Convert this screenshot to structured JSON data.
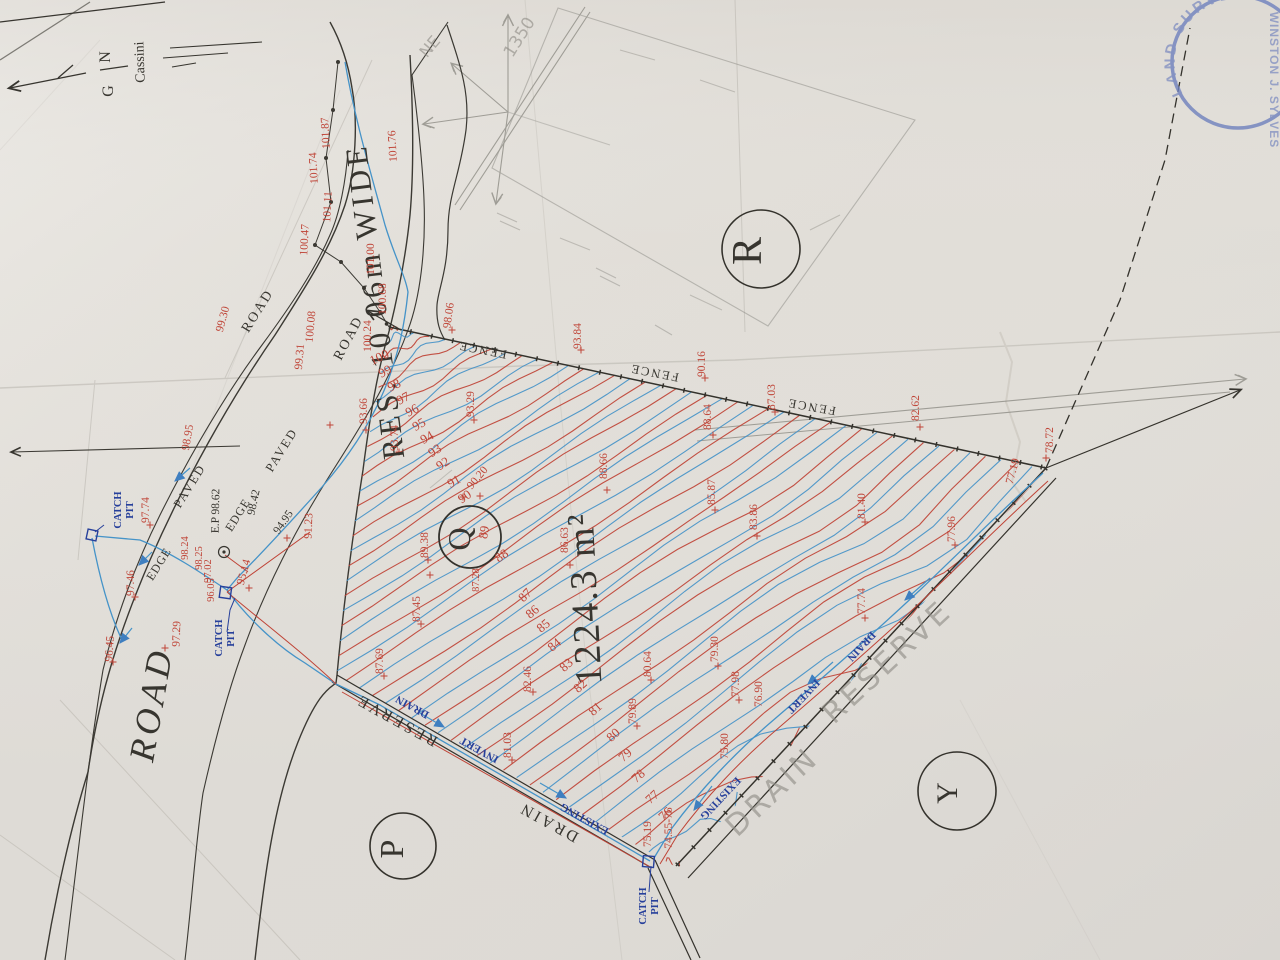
{
  "colors": {
    "paper": "#e1ded8",
    "red": "#bf4336",
    "blue": "#4593c8",
    "navy": "#27409b",
    "ink": "#37352f",
    "pencil": "#8e8c85",
    "stamp": "#6e80bd"
  },
  "parcel": {
    "id": "Q",
    "area": "1224.3 m²",
    "adjacent": [
      "R",
      "P",
      "Y"
    ]
  },
  "north": {
    "letters": "G N",
    "datum": "Cassini"
  },
  "stamp": {
    "arc_text": "LAND SURVEY BO",
    "name_text": "WINSTON J. SYLVES"
  },
  "contours": {
    "red_values": [
      100,
      99,
      98,
      97,
      96,
      95,
      94,
      93,
      92,
      91,
      90,
      89,
      88,
      87,
      86,
      85,
      84,
      83,
      82,
      81,
      80,
      79,
      78,
      77,
      76
    ],
    "blue_intermediate": true
  },
  "labels": [
    {
      "n": "north-letter-n",
      "t": "N",
      "x": 110,
      "y": 57,
      "r": -90,
      "c": "ink",
      "s": 16
    },
    {
      "n": "north-letter-g",
      "t": "G",
      "x": 113,
      "y": 91,
      "r": -90,
      "c": "ink",
      "s": 16
    },
    {
      "n": "north-datum",
      "t": "Cassini",
      "x": 144,
      "y": 62,
      "r": -92,
      "c": "ink",
      "s": 14
    },
    {
      "n": "road-title",
      "t": "ROAD",
      "x": 163,
      "y": 706,
      "r": -80,
      "c": "ink",
      "s": 36,
      "ls": 5,
      "fs": "italic"
    },
    {
      "n": "road-reserve-title",
      "t": "RES. 10.06m WIDE",
      "x": 385,
      "y": 300,
      "r": -97,
      "c": "ink",
      "s": 31,
      "ls": 4
    },
    {
      "n": "road-label",
      "t": "ROAD",
      "x": 261,
      "y": 313,
      "r": -58,
      "c": "ink",
      "s": 14,
      "ls": 2
    },
    {
      "n": "road-label",
      "t": "ROAD",
      "x": 352,
      "y": 340,
      "r": -62,
      "c": "ink",
      "s": 14,
      "ls": 2
    },
    {
      "n": "paved-label",
      "t": "PAVED",
      "x": 193,
      "y": 488,
      "r": -58,
      "c": "ink",
      "s": 12.5,
      "ls": 2
    },
    {
      "n": "paved-label",
      "t": "PAVED",
      "x": 285,
      "y": 452,
      "r": -58,
      "c": "ink",
      "s": 12.5,
      "ls": 2
    },
    {
      "n": "edge-label",
      "t": "EDGE",
      "x": 162,
      "y": 566,
      "r": -58,
      "c": "ink",
      "s": 12,
      "ls": 1
    },
    {
      "n": "edge-label",
      "t": "EDGE",
      "x": 241,
      "y": 517,
      "r": -58,
      "c": "ink",
      "s": 12,
      "ls": 1
    },
    {
      "n": "fence-label",
      "t": "FENCE",
      "x": 483,
      "y": 346,
      "r": -169,
      "c": "ink",
      "s": 12.5,
      "ls": 2
    },
    {
      "n": "fence-label",
      "t": "FENCE",
      "x": 655,
      "y": 369,
      "r": -169,
      "c": "ink",
      "s": 12.5,
      "ls": 2
    },
    {
      "n": "fence-label",
      "t": "FENCE",
      "x": 812,
      "y": 403,
      "r": -170,
      "c": "ink",
      "s": 12.5,
      "ls": 2
    },
    {
      "n": "reserve-label",
      "t": "RESERVE",
      "x": 399,
      "y": 716,
      "r": -151,
      "c": "ink",
      "s": 16,
      "ls": 3
    },
    {
      "n": "drain-label",
      "t": "DRAIN",
      "x": 551,
      "y": 818,
      "r": -151,
      "c": "ink",
      "s": 16,
      "ls": 3
    },
    {
      "n": "parcel-q",
      "t": "Q",
      "x": 470,
      "y": 539,
      "r": -90,
      "c": "ink",
      "s": 32
    },
    {
      "n": "parcel-area",
      "t": "1224.3 m²",
      "x": 597,
      "y": 598,
      "r": -93,
      "c": "ink",
      "s": 38,
      "ls": 2
    },
    {
      "n": "parcel-r",
      "t": "R",
      "x": 761,
      "y": 251,
      "r": -90,
      "c": "ink",
      "s": 42
    },
    {
      "n": "parcel-p",
      "t": "P",
      "x": 403,
      "y": 849,
      "r": -90,
      "c": "ink",
      "s": 34
    },
    {
      "n": "parcel-y",
      "t": "Y",
      "x": 957,
      "y": 793,
      "r": -90,
      "c": "ink",
      "s": 30
    },
    {
      "n": "catch-pit-label",
      "t": "CATCH",
      "x": 121,
      "y": 510,
      "r": -90,
      "c": "navy",
      "s": 10.5,
      "fw": "bold"
    },
    {
      "n": "catch-pit-label",
      "t": "PIT",
      "x": 133,
      "y": 510,
      "r": -90,
      "c": "navy",
      "s": 10.5,
      "fw": "bold"
    },
    {
      "n": "catch-pit-label",
      "t": "CATCH",
      "x": 222,
      "y": 638,
      "r": -90,
      "c": "navy",
      "s": 10.5,
      "fw": "bold"
    },
    {
      "n": "catch-pit-label",
      "t": "PIT",
      "x": 234,
      "y": 638,
      "r": -90,
      "c": "navy",
      "s": 10.5,
      "fw": "bold"
    },
    {
      "n": "catch-pit-label",
      "t": "CATCH",
      "x": 646,
      "y": 906,
      "r": -90,
      "c": "navy",
      "s": 10.5,
      "fw": "bold"
    },
    {
      "n": "catch-pit-label",
      "t": "PIT",
      "x": 658,
      "y": 906,
      "r": -90,
      "c": "navy",
      "s": 10.5,
      "fw": "bold"
    },
    {
      "n": "electric-pole-label",
      "t": "E.P 98.62",
      "x": 219,
      "y": 511,
      "r": -89,
      "c": "ink",
      "s": 11.5
    },
    {
      "n": "spot-black",
      "t": "98.42",
      "x": 257,
      "y": 503,
      "r": -78,
      "c": "ink",
      "s": 11.5
    },
    {
      "n": "spot-black",
      "t": "94.95",
      "x": 286,
      "y": 524,
      "r": -55,
      "c": "ink",
      "s": 11.5
    },
    {
      "n": "drain-text",
      "t": "DRAIN",
      "x": 414,
      "y": 704,
      "r": -151,
      "c": "navy",
      "s": 11,
      "fw": "bold"
    },
    {
      "n": "drain-text",
      "t": "INVERT",
      "x": 481,
      "y": 747,
      "r": -151,
      "c": "navy",
      "s": 11,
      "fw": "bold"
    },
    {
      "n": "drain-text",
      "t": "EXISTING",
      "x": 586,
      "y": 816,
      "r": -151,
      "c": "navy",
      "s": 11,
      "fw": "bold"
    },
    {
      "n": "drain-text",
      "t": "DRAIN",
      "x": 859,
      "y": 644,
      "r": 133,
      "c": "navy",
      "s": 11,
      "fw": "bold"
    },
    {
      "n": "drain-text",
      "t": "INVERT",
      "x": 801,
      "y": 694,
      "r": 133,
      "c": "navy",
      "s": 11,
      "fw": "bold"
    },
    {
      "n": "drain-text",
      "t": "EXISTING",
      "x": 718,
      "y": 796,
      "r": 133,
      "c": "navy",
      "s": 11,
      "fw": "bold"
    },
    {
      "n": "pencil-ne",
      "t": "NE",
      "x": 434,
      "y": 50,
      "r": -50,
      "c": "pencil",
      "s": 16,
      "hand": true
    },
    {
      "n": "pencil-1350",
      "t": "1350",
      "x": 524,
      "y": 40,
      "r": -58,
      "c": "pencil",
      "s": 17,
      "hand": true
    },
    {
      "n": "pencil-drain",
      "t": "DRAIN",
      "x": 779,
      "y": 799,
      "r": -43,
      "c": "pencil",
      "s": 30,
      "ls": 4,
      "hand": true
    },
    {
      "n": "pencil-reserve",
      "t": "RESERVE",
      "x": 894,
      "y": 669,
      "r": -43,
      "c": "pencil",
      "s": 30,
      "ls": 4,
      "hand": true
    },
    {
      "n": "spot-elev",
      "t": "101.87",
      "x": 329,
      "y": 133,
      "r": -93,
      "c": "red",
      "s": 11.5
    },
    {
      "n": "spot-elev",
      "t": "101.74",
      "x": 317,
      "y": 168,
      "r": -93,
      "c": "red",
      "s": 11.5
    },
    {
      "n": "spot-elev",
      "t": "101.76",
      "x": 396,
      "y": 146,
      "r": -93,
      "c": "red",
      "s": 11.5
    },
    {
      "n": "spot-elev",
      "t": "101.11",
      "x": 331,
      "y": 207,
      "r": -87,
      "c": "red",
      "s": 11.5
    },
    {
      "n": "spot-elev",
      "t": "100.47",
      "x": 308,
      "y": 240,
      "r": -87,
      "c": "red",
      "s": 11.5
    },
    {
      "n": "spot-elev",
      "t": "101.00",
      "x": 374,
      "y": 259,
      "r": -90,
      "c": "red",
      "s": 11.5
    },
    {
      "n": "spot-elev",
      "t": "100.68",
      "x": 386,
      "y": 299,
      "r": -90,
      "c": "red",
      "s": 11.5
    },
    {
      "n": "spot-elev",
      "t": "100.24",
      "x": 371,
      "y": 336,
      "r": -90,
      "c": "red",
      "s": 11.5
    },
    {
      "n": "spot-elev",
      "t": "100.08",
      "x": 314,
      "y": 327,
      "r": -85,
      "c": "red",
      "s": 11.5
    },
    {
      "n": "spot-elev",
      "t": "99.31",
      "x": 303,
      "y": 357,
      "r": -85,
      "c": "red",
      "s": 11.5
    },
    {
      "n": "spot-elev",
      "t": "99.30",
      "x": 226,
      "y": 320,
      "r": -75,
      "c": "red",
      "s": 11.5
    },
    {
      "n": "spot-elev",
      "t": "98.95",
      "x": 191,
      "y": 438,
      "r": -80,
      "c": "red",
      "s": 11.5
    },
    {
      "n": "spot-elev",
      "t": "98.06",
      "x": 452,
      "y": 316,
      "r": -82,
      "c": "red",
      "s": 11.5
    },
    {
      "n": "spot-elev",
      "t": "97.74",
      "x": 149,
      "y": 510,
      "r": -90,
      "c": "red",
      "s": 11.5
    },
    {
      "n": "spot-elev",
      "t": "97.46",
      "x": 134,
      "y": 583,
      "r": -90,
      "c": "red",
      "s": 11.5
    },
    {
      "n": "spot-elev",
      "t": "97.29",
      "x": 180,
      "y": 634,
      "r": -88,
      "c": "red",
      "s": 11.5
    },
    {
      "n": "spot-elev",
      "t": "96.45",
      "x": 113,
      "y": 649,
      "r": -86,
      "c": "red",
      "s": 11.5
    },
    {
      "n": "spot-elev",
      "t": "98.24",
      "x": 188,
      "y": 548,
      "r": -90,
      "c": "red",
      "s": 10.5
    },
    {
      "n": "spot-elev",
      "t": "98.25",
      "x": 202,
      "y": 558,
      "r": -90,
      "c": "red",
      "s": 10.5
    },
    {
      "n": "spot-elev",
      "t": "97.02",
      "x": 211,
      "y": 571,
      "r": -90,
      "c": "red",
      "s": 10.5
    },
    {
      "n": "spot-elev",
      "t": "96.05",
      "x": 214,
      "y": 590,
      "r": -90,
      "c": "red",
      "s": 10.5
    },
    {
      "n": "spot-elev",
      "t": "95.14",
      "x": 247,
      "y": 573,
      "r": -75,
      "c": "red",
      "s": 11.5
    },
    {
      "n": "spot-elev",
      "t": "93.84",
      "x": 581,
      "y": 336,
      "r": -90,
      "c": "red",
      "s": 11.5
    },
    {
      "n": "spot-elev",
      "t": "90.16",
      "x": 705,
      "y": 364,
      "r": -90,
      "c": "red",
      "s": 11.5
    },
    {
      "n": "spot-elev",
      "t": "87.03",
      "x": 775,
      "y": 397,
      "r": -90,
      "c": "red",
      "s": 11.5
    },
    {
      "n": "spot-elev",
      "t": "82.62",
      "x": 919,
      "y": 408,
      "r": -90,
      "c": "red",
      "s": 11.5
    },
    {
      "n": "spot-elev",
      "t": "78.72",
      "x": 1053,
      "y": 440,
      "r": -90,
      "c": "red",
      "s": 11.5
    },
    {
      "n": "spot-elev",
      "t": "88.64",
      "x": 711,
      "y": 417,
      "r": -90,
      "c": "red",
      "s": 11.5
    },
    {
      "n": "spot-elev",
      "t": "88.66",
      "x": 607,
      "y": 466,
      "r": -90,
      "c": "red",
      "s": 11.5
    },
    {
      "n": "spot-elev",
      "t": "86.63",
      "x": 568,
      "y": 540,
      "r": -90,
      "c": "red",
      "s": 11.5
    },
    {
      "n": "spot-elev",
      "t": "85.87",
      "x": 715,
      "y": 492,
      "r": -90,
      "c": "red",
      "s": 11.5
    },
    {
      "n": "spot-elev",
      "t": "83.86",
      "x": 757,
      "y": 517,
      "r": -90,
      "c": "red",
      "s": 11.5
    },
    {
      "n": "spot-elev",
      "t": "81.40",
      "x": 865,
      "y": 506,
      "r": -90,
      "c": "red",
      "s": 11.5
    },
    {
      "n": "spot-elev",
      "t": "77.96",
      "x": 955,
      "y": 529,
      "r": -90,
      "c": "red",
      "s": 11.5
    },
    {
      "n": "spot-elev",
      "t": "77.19",
      "x": 1016,
      "y": 472,
      "r": -75,
      "c": "red",
      "s": 11.5
    },
    {
      "n": "spot-elev",
      "t": "77.74",
      "x": 865,
      "y": 601,
      "r": -90,
      "c": "red",
      "s": 11.5
    },
    {
      "n": "spot-elev",
      "t": "79.30",
      "x": 718,
      "y": 649,
      "r": -90,
      "c": "red",
      "s": 11.5
    },
    {
      "n": "spot-elev",
      "t": "77.98",
      "x": 739,
      "y": 684,
      "r": -90,
      "c": "red",
      "s": 11.5
    },
    {
      "n": "spot-elev",
      "t": "76.90",
      "x": 762,
      "y": 694,
      "r": -90,
      "c": "red",
      "s": 11.5
    },
    {
      "n": "spot-elev",
      "t": "75.80",
      "x": 728,
      "y": 746,
      "r": -90,
      "c": "red",
      "s": 11.5
    },
    {
      "n": "spot-elev",
      "t": "75.19",
      "x": 651,
      "y": 834,
      "r": -90,
      "c": "red",
      "s": 11.5
    },
    {
      "n": "spot-elev",
      "t": "74.55-76",
      "x": 672,
      "y": 828,
      "r": -90,
      "c": "red",
      "s": 11.5
    },
    {
      "n": "spot-elev",
      "t": "79.89",
      "x": 636,
      "y": 711,
      "r": -90,
      "c": "red",
      "s": 11.5
    },
    {
      "n": "spot-elev",
      "t": "80.64",
      "x": 651,
      "y": 664,
      "r": -90,
      "c": "red",
      "s": 11.5
    },
    {
      "n": "spot-elev",
      "t": "82.46",
      "x": 531,
      "y": 679,
      "r": -90,
      "c": "red",
      "s": 11.5
    },
    {
      "n": "spot-elev",
      "t": "81.03",
      "x": 511,
      "y": 745,
      "r": -90,
      "c": "red",
      "s": 11.5
    },
    {
      "n": "spot-elev",
      "t": "87.69",
      "x": 383,
      "y": 661,
      "r": -90,
      "c": "red",
      "s": 11.5
    },
    {
      "n": "spot-elev",
      "t": "87.45",
      "x": 420,
      "y": 609,
      "r": -90,
      "c": "red",
      "s": 11.5
    },
    {
      "n": "spot-elev",
      "t": "89.38",
      "x": 428,
      "y": 545,
      "r": -90,
      "c": "red",
      "s": 11.5
    },
    {
      "n": "spot-elev",
      "t": "93.66",
      "x": 367,
      "y": 411,
      "r": -90,
      "c": "red",
      "s": 11.5
    },
    {
      "n": "spot-elev",
      "t": "93.74",
      "x": 398,
      "y": 438,
      "r": -90,
      "c": "red",
      "s": 11.5
    },
    {
      "n": "spot-elev",
      "t": "93.29",
      "x": 474,
      "y": 404,
      "r": -90,
      "c": "red",
      "s": 11.5
    },
    {
      "n": "spot-elev",
      "t": "91.23",
      "x": 312,
      "y": 526,
      "r": -88,
      "c": "red",
      "s": 11.5
    },
    {
      "n": "spot-elev",
      "t": "90.20",
      "x": 480,
      "y": 480,
      "r": -50,
      "c": "red",
      "s": 11.5
    },
    {
      "n": "spot-elev",
      "t": "87.28",
      "x": 479,
      "y": 580,
      "r": -90,
      "c": "red",
      "s": 10.5
    },
    {
      "n": "contour-label",
      "t": "100",
      "x": 381,
      "y": 361,
      "r": -25,
      "c": "red",
      "s": 13
    },
    {
      "n": "contour-label",
      "t": "99",
      "x": 387,
      "y": 375,
      "r": -28,
      "c": "red",
      "s": 13
    },
    {
      "n": "contour-label",
      "t": "98",
      "x": 396,
      "y": 389,
      "r": -28,
      "c": "red",
      "s": 13
    },
    {
      "n": "contour-label",
      "t": "97",
      "x": 405,
      "y": 402,
      "r": -28,
      "c": "red",
      "s": 13
    },
    {
      "n": "contour-label",
      "t": "96",
      "x": 414,
      "y": 414,
      "r": -28,
      "c": "red",
      "s": 13
    },
    {
      "n": "contour-label",
      "t": "95",
      "x": 421,
      "y": 428,
      "r": -30,
      "c": "red",
      "s": 13
    },
    {
      "n": "contour-label",
      "t": "94",
      "x": 429,
      "y": 441,
      "r": -30,
      "c": "red",
      "s": 13
    },
    {
      "n": "contour-label",
      "t": "93",
      "x": 437,
      "y": 454,
      "r": -32,
      "c": "red",
      "s": 13
    },
    {
      "n": "contour-label",
      "t": "92",
      "x": 445,
      "y": 467,
      "r": -32,
      "c": "red",
      "s": 13
    },
    {
      "n": "contour-label",
      "t": "91",
      "x": 456,
      "y": 485,
      "r": -30,
      "c": "red",
      "s": 13
    },
    {
      "n": "contour-label",
      "t": "90",
      "x": 467,
      "y": 500,
      "r": -35,
      "c": "red",
      "s": 13
    },
    {
      "n": "contour-label",
      "t": "89",
      "x": 488,
      "y": 533,
      "r": -80,
      "c": "red",
      "s": 13
    },
    {
      "n": "contour-label",
      "t": "88",
      "x": 504,
      "y": 559,
      "r": -35,
      "c": "red",
      "s": 13
    },
    {
      "n": "contour-label",
      "t": "87",
      "x": 528,
      "y": 598,
      "r": -45,
      "c": "red",
      "s": 13
    },
    {
      "n": "contour-label",
      "t": "86",
      "x": 535,
      "y": 615,
      "r": -40,
      "c": "red",
      "s": 13
    },
    {
      "n": "contour-label",
      "t": "85",
      "x": 546,
      "y": 629,
      "r": -40,
      "c": "red",
      "s": 13
    },
    {
      "n": "contour-label",
      "t": "84",
      "x": 557,
      "y": 648,
      "r": -40,
      "c": "red",
      "s": 13
    },
    {
      "n": "contour-label",
      "t": "83",
      "x": 569,
      "y": 668,
      "r": -42,
      "c": "red",
      "s": 13
    },
    {
      "n": "contour-label",
      "t": "82",
      "x": 583,
      "y": 689,
      "r": -42,
      "c": "red",
      "s": 13
    },
    {
      "n": "contour-label",
      "t": "81",
      "x": 598,
      "y": 712,
      "r": -42,
      "c": "red",
      "s": 13
    },
    {
      "n": "contour-label",
      "t": "80",
      "x": 616,
      "y": 738,
      "r": -42,
      "c": "red",
      "s": 13
    },
    {
      "n": "contour-label",
      "t": "79",
      "x": 628,
      "y": 758,
      "r": -42,
      "c": "red",
      "s": 13
    },
    {
      "n": "contour-label",
      "t": "78",
      "x": 641,
      "y": 779,
      "r": -42,
      "c": "red",
      "s": 13
    },
    {
      "n": "contour-label",
      "t": "77",
      "x": 655,
      "y": 800,
      "r": -42,
      "c": "red",
      "s": 13
    },
    {
      "n": "contour-label",
      "t": "76",
      "x": 668,
      "y": 817,
      "r": -42,
      "c": "red",
      "s": 13
    }
  ]
}
